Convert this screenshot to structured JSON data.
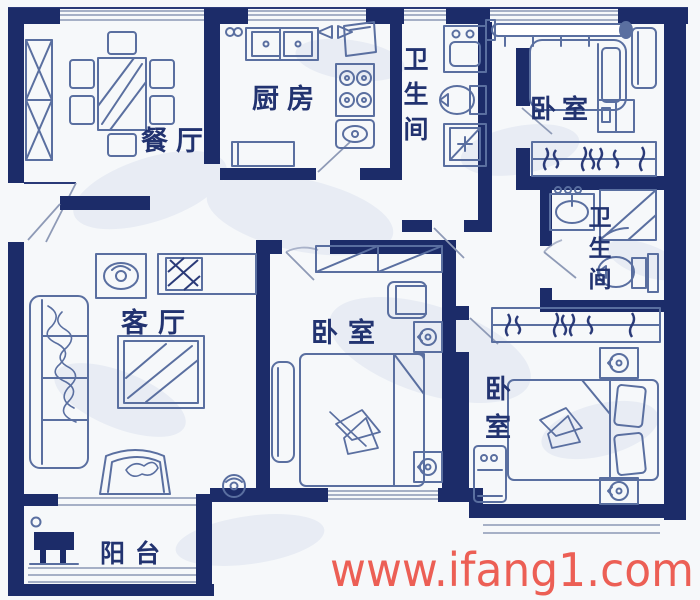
{
  "title": "apartment-floor-plan",
  "watermark": {
    "text": "www.ifang1.com",
    "color": "#ec5f55"
  },
  "colors": {
    "wall": "#1c2c69",
    "furniture_outline": "#5a6fa0",
    "label_text": "#223370",
    "window_line": "#9aa6bf",
    "background": "#f6f8fa"
  },
  "rooms": {
    "dining": {
      "label": "餐厅"
    },
    "kitchen": {
      "label": "厨房"
    },
    "bath_top": {
      "char1": "卫",
      "char2": "生",
      "char3": "间"
    },
    "bedroom_top_right": {
      "label": "卧室"
    },
    "bath_right": {
      "char1": "卫",
      "char2": "生",
      "char3": "间"
    },
    "living": {
      "label": "客厅"
    },
    "bedroom_middle": {
      "label": "卧室"
    },
    "bedroom_bottom_right": {
      "char1": "卧",
      "char2": "室"
    },
    "balcony": {
      "label": "阳台"
    }
  }
}
